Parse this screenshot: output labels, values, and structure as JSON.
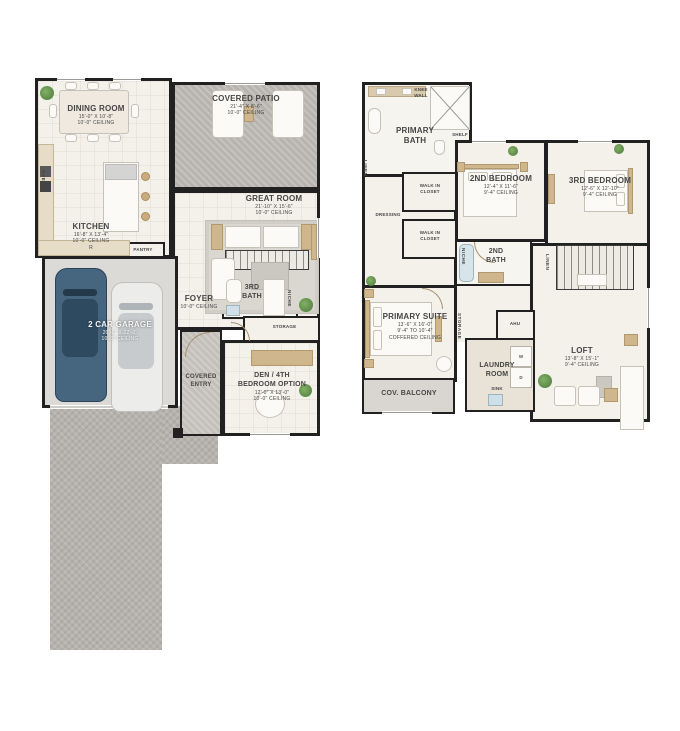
{
  "colors": {
    "walls": "#212121",
    "floor": "#f4f1ea",
    "patio": "#b7b4af",
    "garage_floor": "#dcdad7",
    "driveway": "#b6b3ae",
    "wood_accent": "#cfb68c",
    "plant_green": "#5d8f4e",
    "car_blue": "#46657f",
    "car_white": "#ececea"
  },
  "floor1": {
    "dining": {
      "name": "DINING ROOM",
      "dims": "15'-0\" X 10'-8\"",
      "ceiling": "10'-0\" CEILING"
    },
    "patio": {
      "name": "COVERED PATIO",
      "dims": "21'-4\" X 8'-6\"",
      "ceiling": "10'-0\" CEILING"
    },
    "great": {
      "name": "GREAT ROOM",
      "dims": "21'-10\" X 15'-6\"",
      "ceiling": "10'-0\" CEILING"
    },
    "kitchen": {
      "name": "KITCHEN",
      "dims": "16'-8\" X 13'-4\"",
      "ceiling": "10'-0\" CEILING",
      "fridge": "R",
      "oven": "OVEN",
      "pantry": "PANTRY"
    },
    "garage": {
      "name": "2 CAR GARAGE",
      "dims": "20'-0\" X 22'-0\"",
      "ceiling": "10'-0\" CEILING"
    },
    "foyer": {
      "name": "FOYER",
      "ceiling": "10'-0\" CEILING"
    },
    "bath3": {
      "line1": "3RD",
      "line2": "BATH",
      "niche": "NICHE"
    },
    "storage": {
      "name": "STORAGE"
    },
    "entry": {
      "line1": "COVERED",
      "line2": "ENTRY"
    },
    "den": {
      "line1": "DEN / 4TH",
      "line2": "BEDROOM OPTION",
      "dims": "12'-0\" X 13'-0\"",
      "ceiling": "10'-0\" CEILING"
    }
  },
  "floor2": {
    "pbath": {
      "line1": "PRIMARY",
      "line2": "BATH",
      "knee1": "KNEE",
      "knee2": "WALL",
      "shelf": "SHELF"
    },
    "bed2": {
      "name": "2ND BEDROOM",
      "dims": "12'-4\" X 11'-6\"",
      "ceiling": "9'-4\" CEILING"
    },
    "bed3": {
      "name": "3RD BEDROOM",
      "dims": "12'-6\" X 12'-10\"",
      "ceiling": "9'-4\" CEILING"
    },
    "wic1": {
      "line1": "WALK IN",
      "line2": "CLOSET"
    },
    "wic2": {
      "line1": "WALK IN",
      "line2": "CLOSET"
    },
    "dressing": {
      "name": "DRESSING"
    },
    "linen1": {
      "name": "LINEN"
    },
    "linen2": {
      "name": "LINEN"
    },
    "bath2": {
      "line1": "2ND",
      "line2": "BATH",
      "niche": "NICHE"
    },
    "psuite": {
      "name": "PRIMARY SUITE",
      "dims": "13'-6\" X 16'-0\"",
      "ceiling1": "9'-4\" TO 10'-4\"",
      "ceiling2": "COFFERED CEILING",
      "storage": "STORAGE"
    },
    "ahu": {
      "name": "AHU"
    },
    "laundry": {
      "line1": "LAUNDRY",
      "line2": "ROOM",
      "sink": "SINK",
      "washer": "W",
      "dryer": "D"
    },
    "loft": {
      "name": "LOFT",
      "dims": "13'-8\" X 15'-1\"",
      "ceiling": "9'-4\" CEILING"
    },
    "balcony": {
      "name": "COV. BALCONY"
    }
  }
}
